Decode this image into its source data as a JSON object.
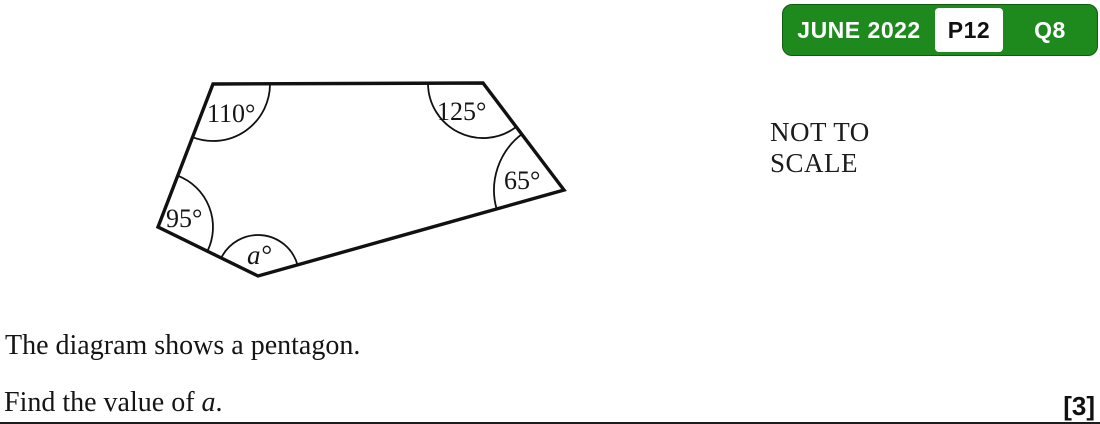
{
  "badge": {
    "session": "JUNE 2022",
    "paper": "P12",
    "question": "Q8",
    "green": "#1e8a1e"
  },
  "note": {
    "line1": "NOT TO",
    "line2": "SCALE"
  },
  "diagram": {
    "shape": "pentagon",
    "angle_labels": {
      "top_left": "110°",
      "top_right": "125°",
      "right": "65°",
      "left": "95°",
      "bottom": "a°"
    }
  },
  "question": {
    "line1": "The diagram shows a pentagon.",
    "line2_prefix": "Find the value of ",
    "line2_var": "a",
    "line2_suffix": ".",
    "marks": "[3]"
  }
}
